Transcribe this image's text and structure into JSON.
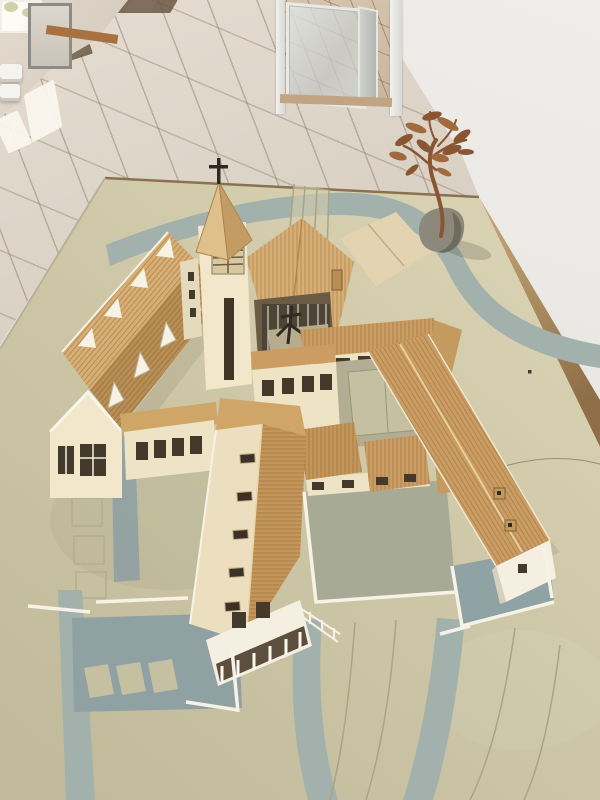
{
  "scene": {
    "type": "photograph",
    "subject": "Architectural scale model of a monastery and church complex on a display table",
    "setting": "Bright indoor hallway with beige tile floor, open glass door and white walls",
    "objects": [
      "tiled hallway floor",
      "window with sunlight",
      "radiator",
      "open glass entry door",
      "white wall",
      "display table",
      "terrain base board with painted roads",
      "church tower with spire and cross",
      "church nave with glazed gable",
      "building with dormer windows",
      "long residential wing",
      "right farm wing with chimneys",
      "inner courtyard",
      "walled gardens",
      "parking areas",
      "contour terraces",
      "bronze tree sculpture on a stone base"
    ]
  },
  "colors": {
    "wallWhite": "#eae8e4",
    "wallBeige": "#d8cfc2",
    "floorTile": "#dcd3c7",
    "farFloor": "#c9b6a0",
    "windowLight": "#fcfbf4",
    "radiator": "#f4f3f0",
    "sillBrown": "#a8713f",
    "matBrown": "#6b5742",
    "tableEdgeLight": "#c9a87b",
    "tableEdgeDark": "#8f6f47",
    "boardLight": "#d9d3b3",
    "board": "#ccc6a6",
    "boardDark": "#c1bb9b",
    "road": "#a2b1ac",
    "plaza": "#8fa1a3",
    "yardGreen": "#a7aa95",
    "yardBlue": "#8fa2a4",
    "courtyard": "#b2ad93",
    "slab": "#c6c0a2",
    "contour": "#aaa386",
    "pencil": "#97906f",
    "roofTan": "#cb9d63",
    "roofDark": "#b98e55",
    "roofLight": "#d8ae74",
    "roofPale": "#e4d3b0",
    "roofMid": "#c49659",
    "slopeCream": "#ecdfbf",
    "capTan": "#d0a668",
    "wallCream": "#efe3c6",
    "gableCream": "#f2e7cb",
    "whiteTrim": "#f6f2e6",
    "whiteWall": "#f4efe0",
    "windowDark": "#443a2b",
    "darkCourt": "#6b5b44",
    "glassGrid": "#b9c4c8",
    "louver": "#d8c8a2",
    "spireLight": "#dfc08b",
    "spireDark": "#c49c63",
    "crossDark": "#2f2a22",
    "chimney": "#c59a5f",
    "bronze": "#8a5532",
    "bronzeLight": "#a06a3e",
    "rock": "#8d887c",
    "rockShade": "#6f6a5e"
  }
}
